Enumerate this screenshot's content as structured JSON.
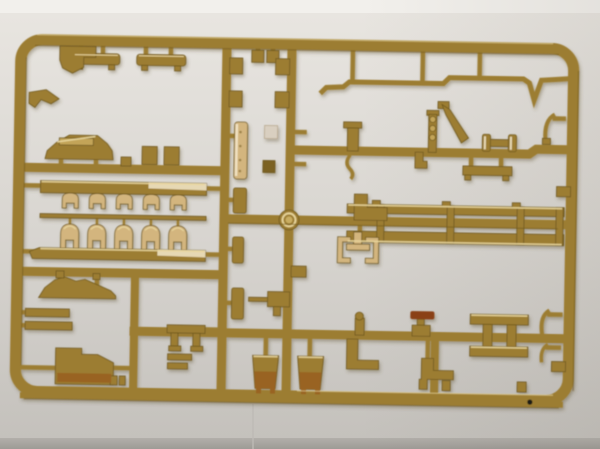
{
  "scene": {
    "type": "photograph",
    "subject": "injection-molded model kit sprue (parts tree) of tan plastic lying on a light gray backdrop",
    "tilt_degrees": 1,
    "frame": "rounded rectangular outer runner frame with internal runner grid and many small molded parts",
    "background": "light gray surface, brighter strip at top, darker band at bottom, faint vertical backdrop seam lower center"
  },
  "colors": {
    "bg_top_strip": "#f2f0ec",
    "bg_top": "#e9e6e1",
    "bg_mid": "#d7d4cf",
    "bg_bottom": "#c3c0bb",
    "bg_foot_top": "#b2afaa",
    "bg_foot_bottom": "#9e9b96",
    "seam": "#bdbab5",
    "vignette_start": "rgba(108,102,92,0)",
    "vignette_end": "rgba(108,102,92,0.10)",
    "plastic": "#9c7d31",
    "plastic_edge": "#6f581f",
    "plastic_dark": "#7c6224",
    "plastic_light": "#c3a458",
    "plastic_pale": "#d3b57e",
    "gloss": "#f3e8cb",
    "highlight": "#e9d79f",
    "bucket_dark": "#996320",
    "red_part": "#8a4119",
    "pad_gray": "#d9cfc0",
    "hub_inner": "#c9ad62",
    "shadow": "rgba(96,82,52,0.38)",
    "dot": "#1d1a16"
  },
  "parts_manifest": [
    "outer-frame",
    "runner-v-left-mid",
    "runner-v-center",
    "runner-h-left-upper",
    "runner-h-left-lower",
    "runner-v-far-left",
    "runner-h-middle",
    "runner-h-right-upper",
    "runner-h-lower",
    "runner-v-right-lower",
    "muffler-part-a",
    "muffler-part-b",
    "corner-step-bracket",
    "left-rail-chevron",
    "hull-top-part",
    "clip-pair-upper-left",
    "track-bar-1",
    "track-mounts-row",
    "track-arches-row",
    "track-bar-2",
    "fender-wing-part",
    "left-rail-bars",
    "stowage-box-part",
    "bench-table-part",
    "small-bars-under-table",
    "tall-rivet-plate",
    "vertical-strip-2",
    "vertical-strip-3",
    "vertical-strip-4",
    "rod-bracket-part",
    "top-pads-pair",
    "clip-c",
    "clip-d",
    "clip-e",
    "clip-f",
    "gray-pad",
    "dark-square-pad",
    "bucket-part-1",
    "bucket-part-2",
    "bent-rod-long",
    "post-clamp",
    "s-hook",
    "chain-post",
    "angled-lever",
    "roller-dumbbell",
    "l-bracket-under-runner",
    "flat-bar-under-runner",
    "curve-hook-top",
    "rail-tab-upper",
    "ladder-skirt-top-bar",
    "ladder-skirt-bottom-bar",
    "jaw-clamp-pale",
    "l-duct-part",
    "knob-post",
    "red-cap-bracket",
    "h-frame-part",
    "curve-hook-lower-1",
    "curve-hook-lower-2",
    "rail-tab-lower",
    "l-bend-part-1",
    "stepped-bend-part",
    "sprue-hub",
    "flash-dot"
  ]
}
